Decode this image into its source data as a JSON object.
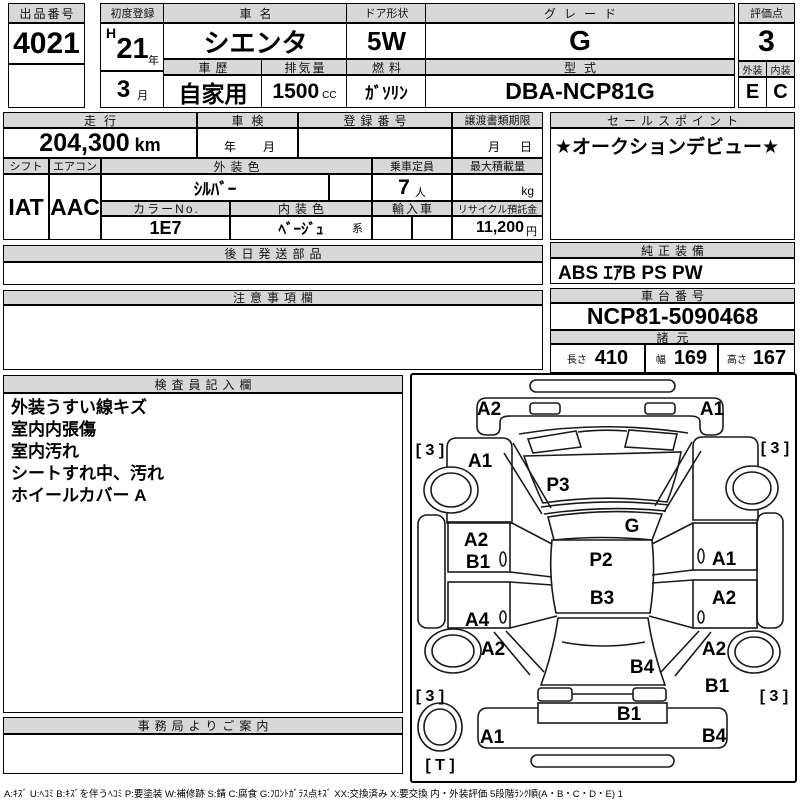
{
  "header": {
    "lot_label": "出品番号",
    "lot_value": "4021",
    "first_reg_label": "初度登録",
    "first_reg_era": "H",
    "first_reg_year": "21",
    "first_reg_year_unit": "年",
    "first_reg_month": "3",
    "first_reg_month_unit": "月",
    "car_name_label": "車名",
    "car_name": "シエンタ",
    "door_label": "ドア形状",
    "door_value": "5W",
    "grade_label": "グレード",
    "grade_value": "G",
    "score_label": "評価点",
    "score_value": "3",
    "history_label": "車歴",
    "history_value": "自家用",
    "displacement_label": "排気量",
    "displacement_value": "1500",
    "displacement_unit": "CC",
    "fuel_label": "燃料",
    "fuel_value": "ｶﾞｿﾘﾝ",
    "model_label": "型式",
    "model_value": "DBA-NCP81G",
    "exterior_label": "外装",
    "exterior_value": "E",
    "interior_label": "内装",
    "interior_value": "C"
  },
  "middle": {
    "mileage_label": "走行",
    "mileage_value": "204,300",
    "mileage_unit": "km",
    "inspection_label": "車検",
    "inspection_year": "年",
    "inspection_month": "月",
    "reg_no_label": "登録番号",
    "transfer_label": "譲渡書類期限",
    "transfer_month": "月",
    "transfer_day": "日",
    "sales_point_label": "セールスポイント",
    "sales_point_value": "★オークションデビュー★",
    "shift_label": "シフト",
    "shift_value": "IAT",
    "aircon_label": "エアコン",
    "aircon_value": "AAC",
    "ext_color_label": "外装色",
    "ext_color_value": "ｼﾙﾊﾞｰ",
    "capacity_label": "乗車定員",
    "capacity_value": "7",
    "capacity_unit": "人",
    "payload_label": "最大積載量",
    "payload_unit": "kg",
    "color_no_label": "カラーNo.",
    "color_no_value": "1E7",
    "int_color_label": "内装色",
    "int_color_value": "ﾍﾞｰｼﾞｭ",
    "int_color_suffix": "系",
    "import_label": "輸入車",
    "recycle_label": "リサイクル預託金",
    "recycle_value": "11,200",
    "recycle_unit": "円"
  },
  "sections": {
    "later_parts_label": "後日発送部品",
    "equipment_label": "純正装備",
    "equipment_value": "ABS ｴｱB PS PW",
    "notes_label": "注意事項欄",
    "chassis_label": "車台番号",
    "chassis_value": "NCP81-5090468",
    "specs_label": "諸元",
    "length_label": "長さ",
    "length_value": "410",
    "width_label": "幅",
    "width_value": "169",
    "height_label": "高さ",
    "height_value": "167",
    "inspector_label": "検査員記入欄",
    "inspector_notes": [
      "外装うすい線キズ",
      "室内内張傷",
      "室内汚れ",
      "シートすれ中、汚れ",
      "ホイールカバー A"
    ],
    "office_label": "事務局よりご案内"
  },
  "diagram": {
    "front_bumper_left": "A2",
    "front_bumper_right": "A1",
    "front_fender_left": "A1",
    "hood": "P3",
    "windshield": "G",
    "front_door_left_upper": "A2",
    "front_door_left_lower": "B1",
    "roof_front": "P2",
    "roof_rear": "B3",
    "front_door_right": "A1",
    "rear_door_right": "A2",
    "rear_door_left": "A4",
    "quarter_left": "A2",
    "quarter_right": "A2",
    "quarter_right_lower": "B1",
    "rear_window": "B4",
    "tailgate": "B1",
    "rear_bumper_left": "A1",
    "rear_bumper_right": "B4",
    "tire_front_left": "[ 3 ]",
    "tire_front_right": "[ 3 ]",
    "tire_rear_left": "[ 3 ]",
    "tire_rear_right": "[ 3 ]",
    "spare_tire": "[ T ]"
  },
  "legend": "A:ｷｽﾞ U:ﾍｺﾐ B:ｷｽﾞを伴うﾍｺﾐ P:要塗装 W:補修跡 S:錆 C:腐食 G:ﾌﾛﾝﾄｶﾞﾗｽ点ｷｽﾞ XX:交換済み X:要交換  内・外装評価 5段階ﾗﾝｸ順(A・B・C・D・E) 1"
}
